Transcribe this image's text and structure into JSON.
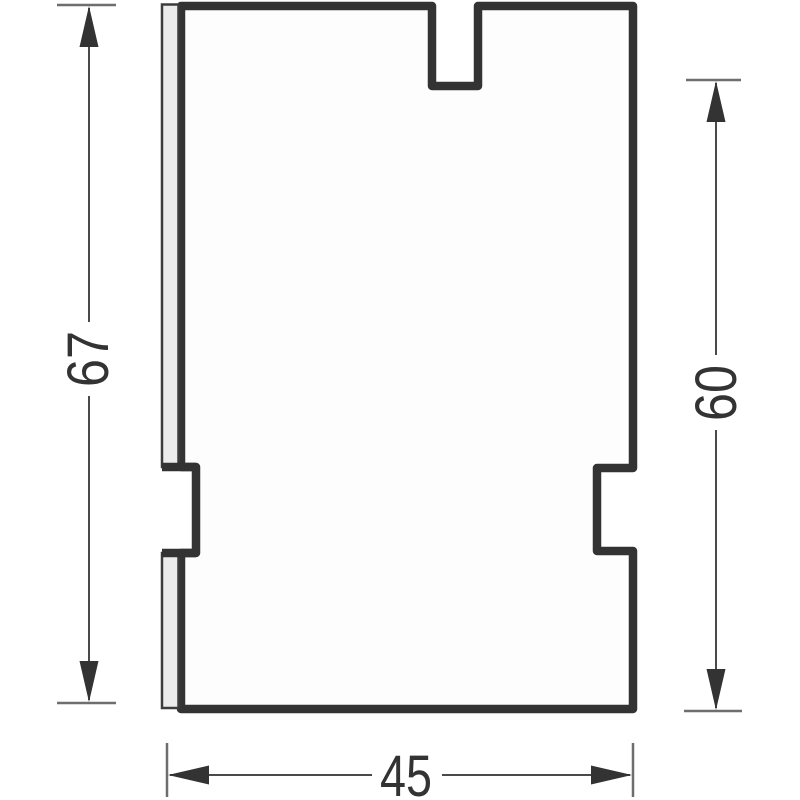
{
  "drawing": {
    "type": "technical-part-drawing",
    "dimensions": {
      "height_left": {
        "value": "67"
      },
      "height_right": {
        "value": "60"
      },
      "width_bottom": {
        "value": "45"
      }
    },
    "colors": {
      "outline": "#333333",
      "strip_fill": "#ececec",
      "dimension_line": "#4a4a4a",
      "extension_line": "#6e6e6e",
      "label_text": "#333333",
      "background": "#ffffff"
    }
  }
}
